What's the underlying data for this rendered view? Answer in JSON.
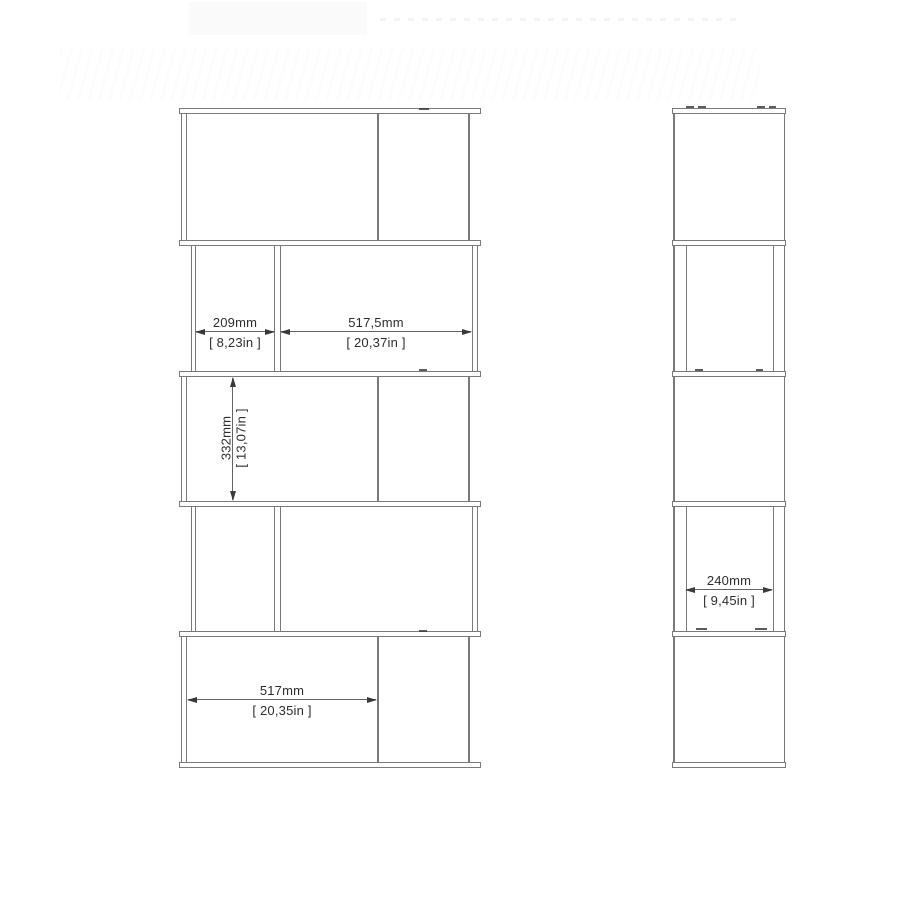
{
  "page": {
    "background": "#ffffff",
    "line_color": "#7a7a7a",
    "dimension_line_color": "#636363",
    "arrow_color": "#3a3a3a",
    "text_color": "#2d2d2d"
  },
  "drawing": {
    "views": {
      "front": {
        "label": "front-elevation"
      },
      "side": {
        "label": "side-elevation"
      }
    },
    "dimensions": {
      "compartment_left_width": {
        "mm": "209mm",
        "inch": "[ 8,23in ]"
      },
      "compartment_right_width": {
        "mm": "517,5mm",
        "inch": "[ 20,37in ]"
      },
      "compartment_height": {
        "mm": "332mm",
        "inch": "[ 13,07in ]"
      },
      "bottom_compartment_width": {
        "mm": "517mm",
        "inch": "[ 20,35in ]"
      },
      "side_depth": {
        "mm": "240mm",
        "inch": "[ 9,45in ]"
      }
    }
  }
}
